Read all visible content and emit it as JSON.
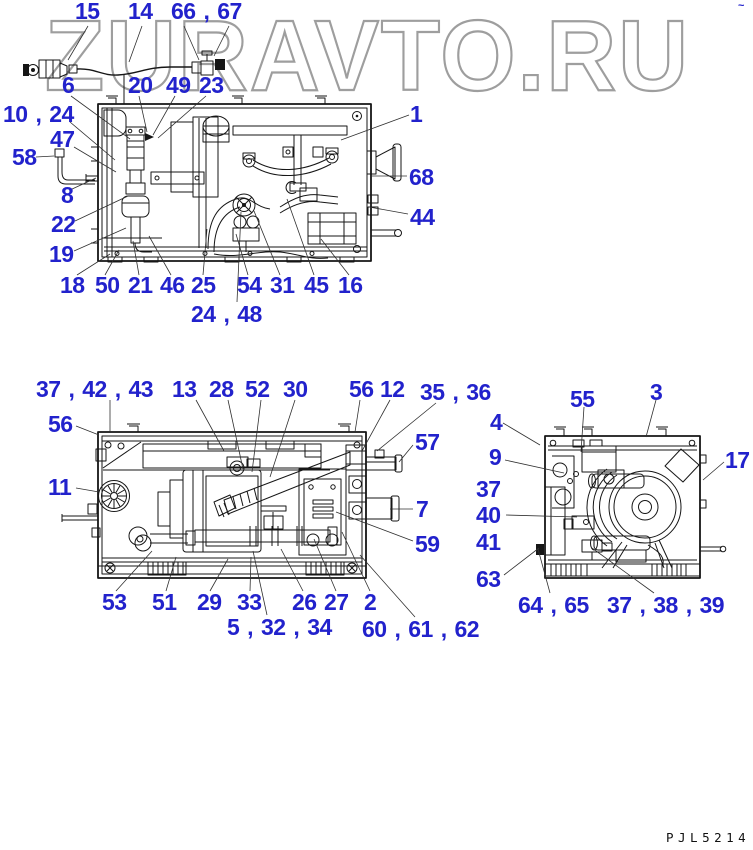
{
  "watermark": "ZURAVTO.RU",
  "footer_code": "PJL5214",
  "corner_mark": "~",
  "colors": {
    "callout_blue": "#2222cc",
    "watermark_gray": "#9e9e9e",
    "line_black": "#161616"
  },
  "callouts": {
    "t15": "15",
    "t14": "14",
    "t66_67": "66 , 67",
    "t6": "6",
    "t20": "20",
    "t49": "49",
    "t23": "23",
    "t10_24": "10 , 24",
    "t47": "47",
    "t58": "58",
    "t8": "8",
    "t22": "22",
    "t19": "19",
    "t18": "18",
    "t50": "50",
    "t21": "21",
    "t46": "46",
    "t25": "25",
    "t54": "54",
    "t31": "31",
    "t45": "45",
    "t16": "16",
    "t24_48": "24 , 48",
    "t1": "1",
    "t68": "68",
    "t44": "44",
    "m37_42_43": "37 , 42 , 43",
    "m13": "13",
    "m28": "28",
    "m52": "52",
    "m30": "30",
    "m56r": "56",
    "m12": "12",
    "m35_36": "35 , 36",
    "m56l": "56",
    "m11": "11",
    "m57": "57",
    "m7": "7",
    "m59": "59",
    "m53": "53",
    "m51": "51",
    "m29": "29",
    "m33": "33",
    "m26": "26",
    "m27": "27",
    "m2": "2",
    "m5_32_34": "5 , 32 , 34",
    "m60_61_62": "60 , 61 , 62",
    "r55": "55",
    "r3": "3",
    "r4": "4",
    "r9": "9",
    "r37": "37",
    "r40": "40",
    "r41": "41",
    "r17": "17",
    "r63": "63",
    "r64_65": "64 , 65",
    "r37_38_39": "37 , 38 , 39"
  }
}
